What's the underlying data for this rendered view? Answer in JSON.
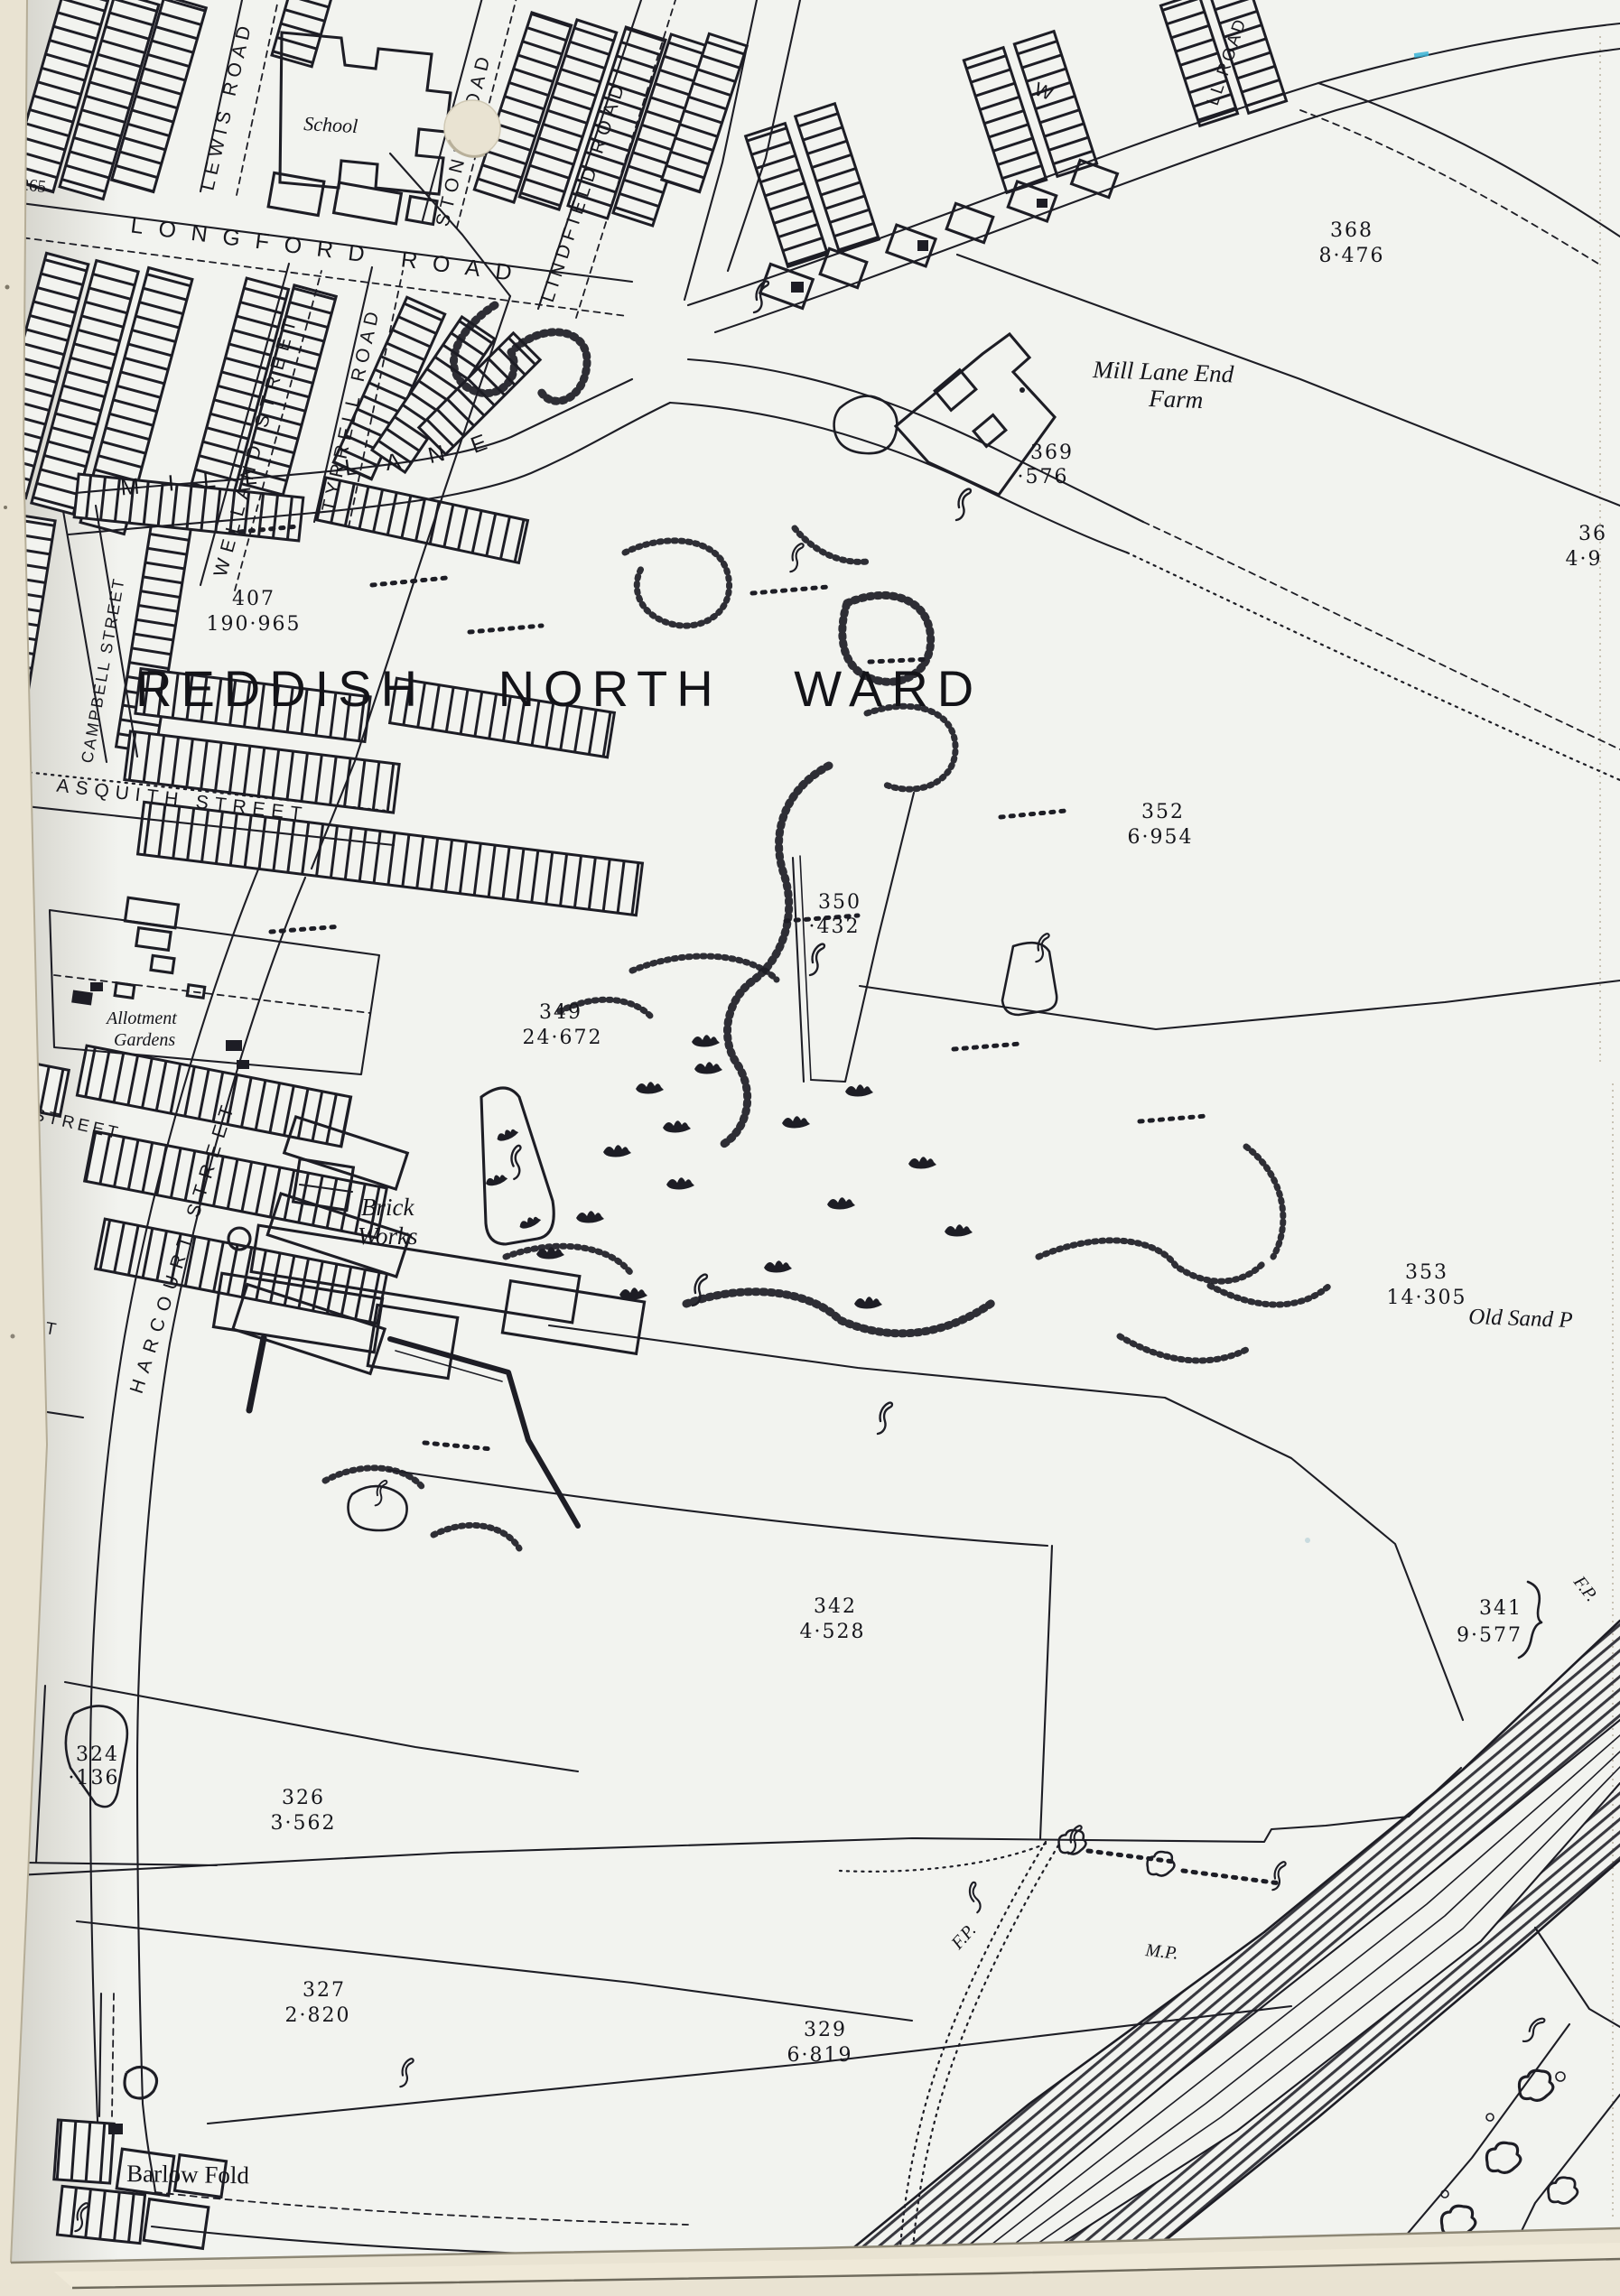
{
  "map": {
    "title": "REDDISH NORTH WARD",
    "edge_number": "265",
    "streets": {
      "lewis_road": "LEWIS ROAD",
      "longford_road": "LONGFORD ROAD",
      "stone_road": "STONE ROAD",
      "lindfield_road": "LINDFIELD ROAD",
      "welland_street": "WELLAND STREET",
      "tyrrell_road": "TYRRELL ROAD",
      "campbell_street": "CAMPBELL STREET",
      "asquith_street": "ASQUITH STREET",
      "mill_lane": "MILL LANE",
      "harcourt_street": "HARCOURT STREET",
      "street_fragment": "STREET",
      "et_fragment": "ET",
      "w_fragment": "W",
      "top_right_road_fragment": "LL ROAD"
    },
    "places": {
      "school": "School",
      "farm_line1": "Mill Lane End",
      "farm_line2": "Farm",
      "brick_works_line1": "Brick",
      "brick_works_line2": "Works",
      "allotment_line1": "Allotment",
      "allotment_line2": "Gardens",
      "barlow_fold": "Barlow Fold",
      "old_sand_pit": "Old Sand P",
      "footpath_1": "F.P.",
      "footpath_2": "F.P.",
      "milepost": "M.P."
    },
    "parcels": [
      {
        "number": "368",
        "area": "8·476"
      },
      {
        "number": "369",
        "area": "·576"
      },
      {
        "number": "36",
        "area": "4·9"
      },
      {
        "number": "407",
        "area": "190·965"
      },
      {
        "number": "352",
        "area": "6·954"
      },
      {
        "number": "350",
        "area": "·432"
      },
      {
        "number": "349",
        "area": "24·672"
      },
      {
        "number": "353",
        "area": "14·305"
      },
      {
        "number": "342",
        "area": "4·528"
      },
      {
        "number": "341",
        "area": "9·577"
      },
      {
        "number": "324",
        "area": "·136"
      },
      {
        "number": "326",
        "area": "3·562"
      },
      {
        "number": "327",
        "area": "2·820"
      },
      {
        "number": "329",
        "area": "6·819"
      }
    ]
  }
}
